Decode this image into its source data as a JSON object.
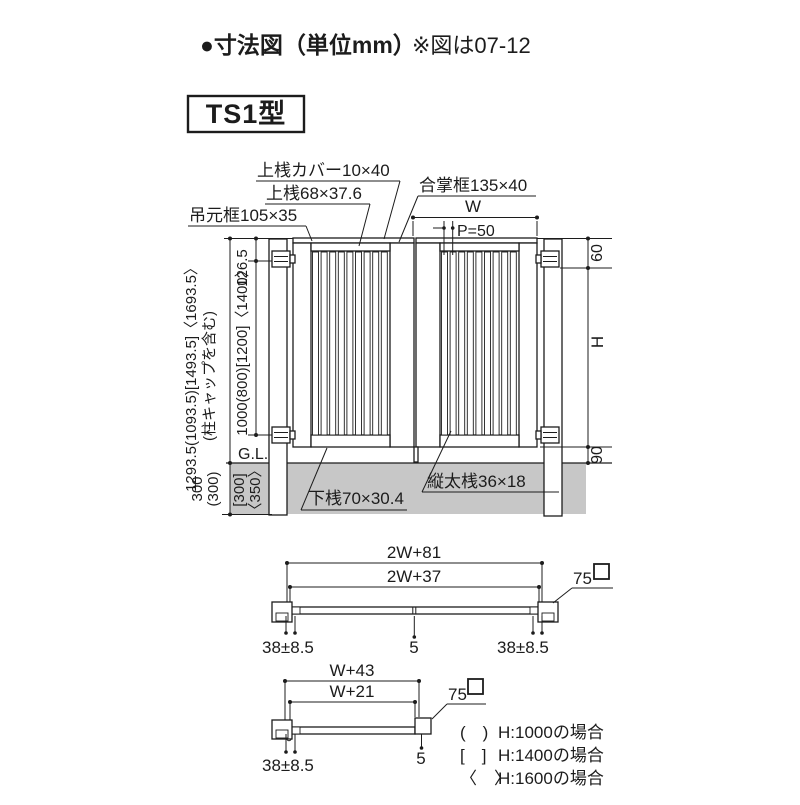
{
  "colors": {
    "line": "#1c1c1c",
    "ground": "#c7c7c7",
    "bg": "#ffffff"
  },
  "title": {
    "main": "●寸法図（単位mm）",
    "note": "※図は07-12"
  },
  "model": "TS1型",
  "parts": {
    "top_rail_cover": "上桟カバー10×40",
    "top_rail": "上桟68×37.6",
    "hinge_stile": "吊元框105×35",
    "meeting_stile": "合掌框135×40",
    "bottom_rail": "下桟70×30.4",
    "vertical_bar": "縦太桟36×18"
  },
  "elevation": {
    "overall_height": "1293.5(1093.5)[1493.5]〈1693.5〉",
    "overall_height_note": "(柱キャップを含む)",
    "top_to_hinge": "126.5",
    "hinge_span": "1000(800)[1200]〈1400〉",
    "ground": "G.L.",
    "embed_a": "300",
    "embed_b": "(300)",
    "embed_c": "[300]",
    "embed_d": "〈350〉",
    "leaf_width": "W",
    "pitch": "P=50",
    "top_offset": "60",
    "height": "H",
    "bottom_clearance": "90"
  },
  "plan_double": {
    "outer": "2W+81",
    "inner": "2W+37",
    "post": "75",
    "gap_left": "38±8.5",
    "gap_center": "5",
    "gap_right": "38±8.5"
  },
  "plan_single": {
    "outer": "W+43",
    "inner": "W+21",
    "post": "75",
    "gap_left": "38±8.5",
    "gap_right": "5"
  },
  "legend": [
    {
      "bracket": "(　)",
      "label": "H:1000の場合"
    },
    {
      "bracket": "[　]",
      "label": "H:1400の場合"
    },
    {
      "bracket": "〈　〉",
      "label": "H:1600の場合"
    }
  ]
}
